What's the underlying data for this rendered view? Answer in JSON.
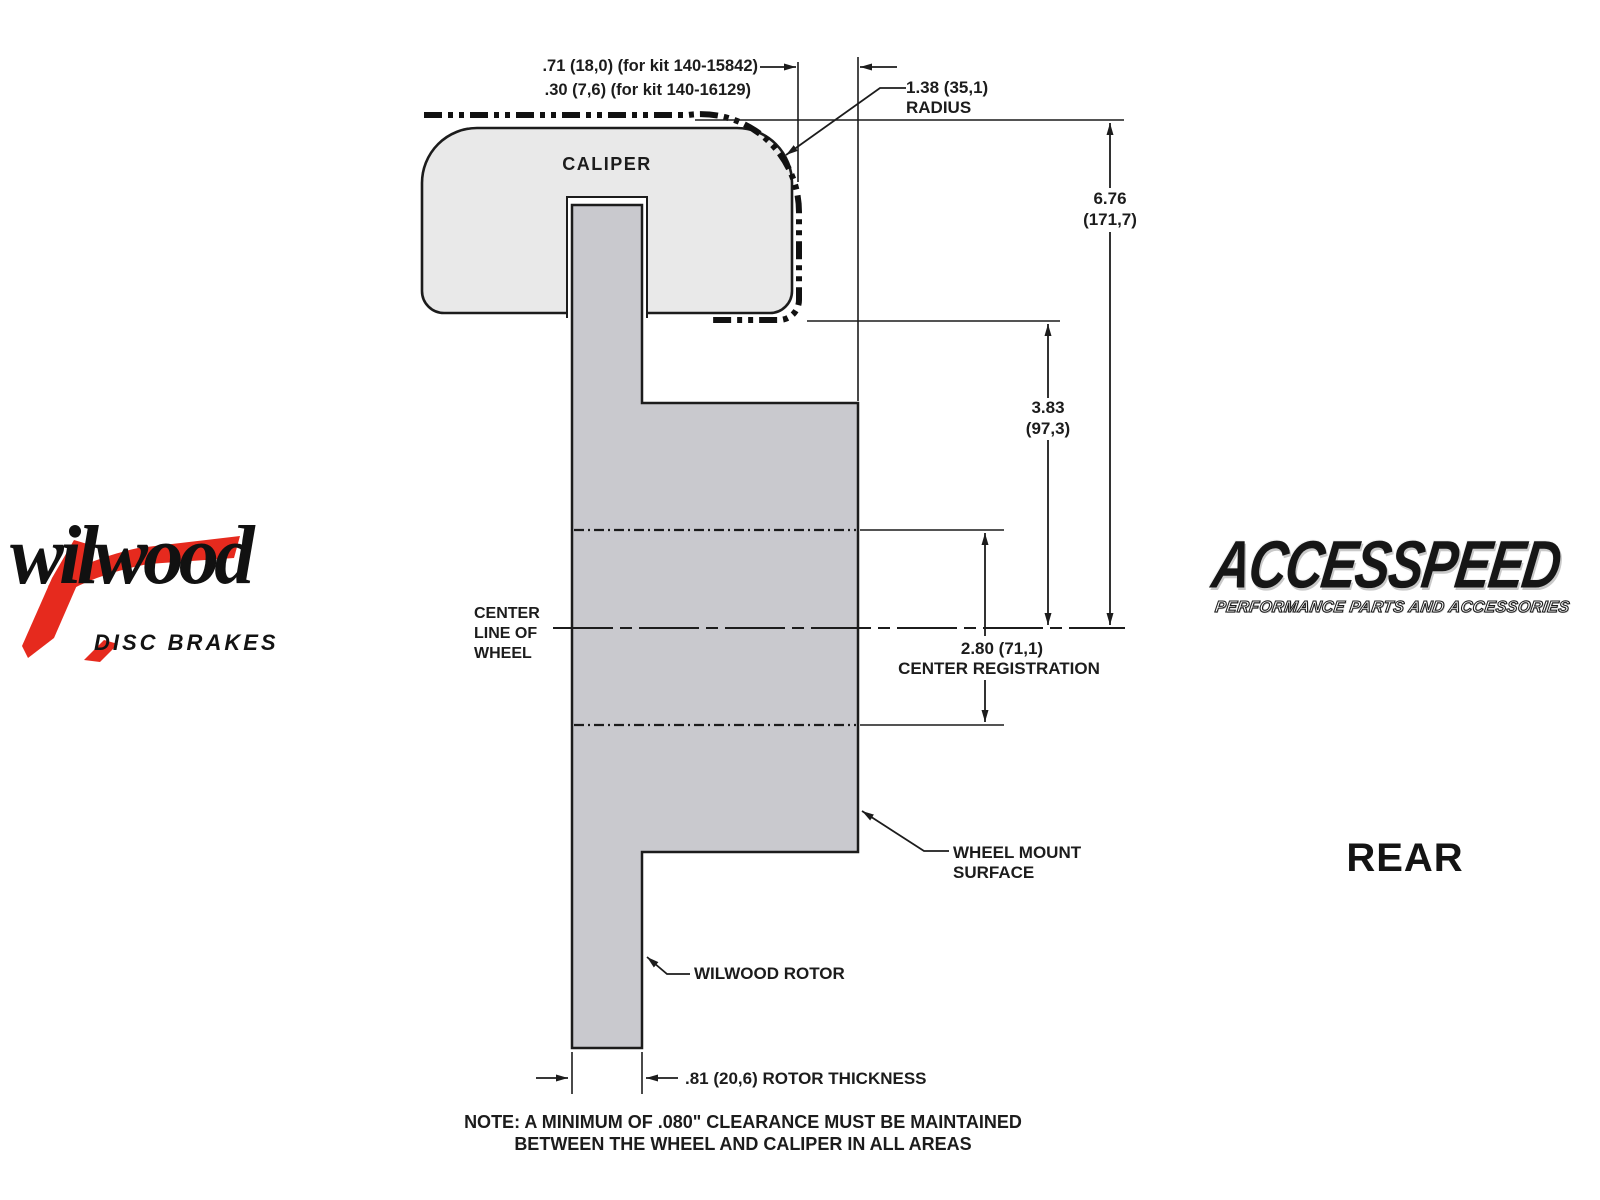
{
  "drawing": {
    "labels": {
      "caliper": "CALIPER",
      "centerline": [
        "CENTER",
        "LINE OF",
        "WHEEL"
      ],
      "wheel_mount": [
        "WHEEL MOUNT",
        "SURFACE"
      ],
      "rotor": "WILWOOD ROTOR",
      "rear": "REAR"
    },
    "dimensions": {
      "kit_offset_1": ".71 (18,0) (for kit 140-15842)",
      "kit_offset_2": ".30 (7,6) (for kit 140-16129)",
      "radius_value": "1.38 (35,1)",
      "radius_word": "RADIUS",
      "overall_height_value": "6.76",
      "overall_height_mm": "(171,7)",
      "caliper_height_value": "3.83",
      "caliper_height_mm": "(97,3)",
      "center_registration_value": "2.80 (71,1)",
      "center_registration_label": "CENTER REGISTRATION",
      "rotor_thickness": ".81 (20,6) ROTOR THICKNESS"
    },
    "note": [
      "NOTE: A MINIMUM OF .080\" CLEARANCE MUST BE MAINTAINED",
      "BETWEEN THE WHEEL AND CALIPER IN ALL AREAS"
    ]
  },
  "logos": {
    "wilwood": {
      "name": "wilwood",
      "tagline": "DISC BRAKES",
      "accent_color": "#e62a1e"
    },
    "accesspeed": {
      "name": "ACCESSPEED",
      "tagline": "PERFORMANCE PARTS AND ACCESSORIES"
    }
  },
  "colors": {
    "caliper_fill": "#e9e9e9",
    "rotor_fill": "#c9c9ce",
    "line": "#1c1c1c",
    "background": "#ffffff"
  }
}
